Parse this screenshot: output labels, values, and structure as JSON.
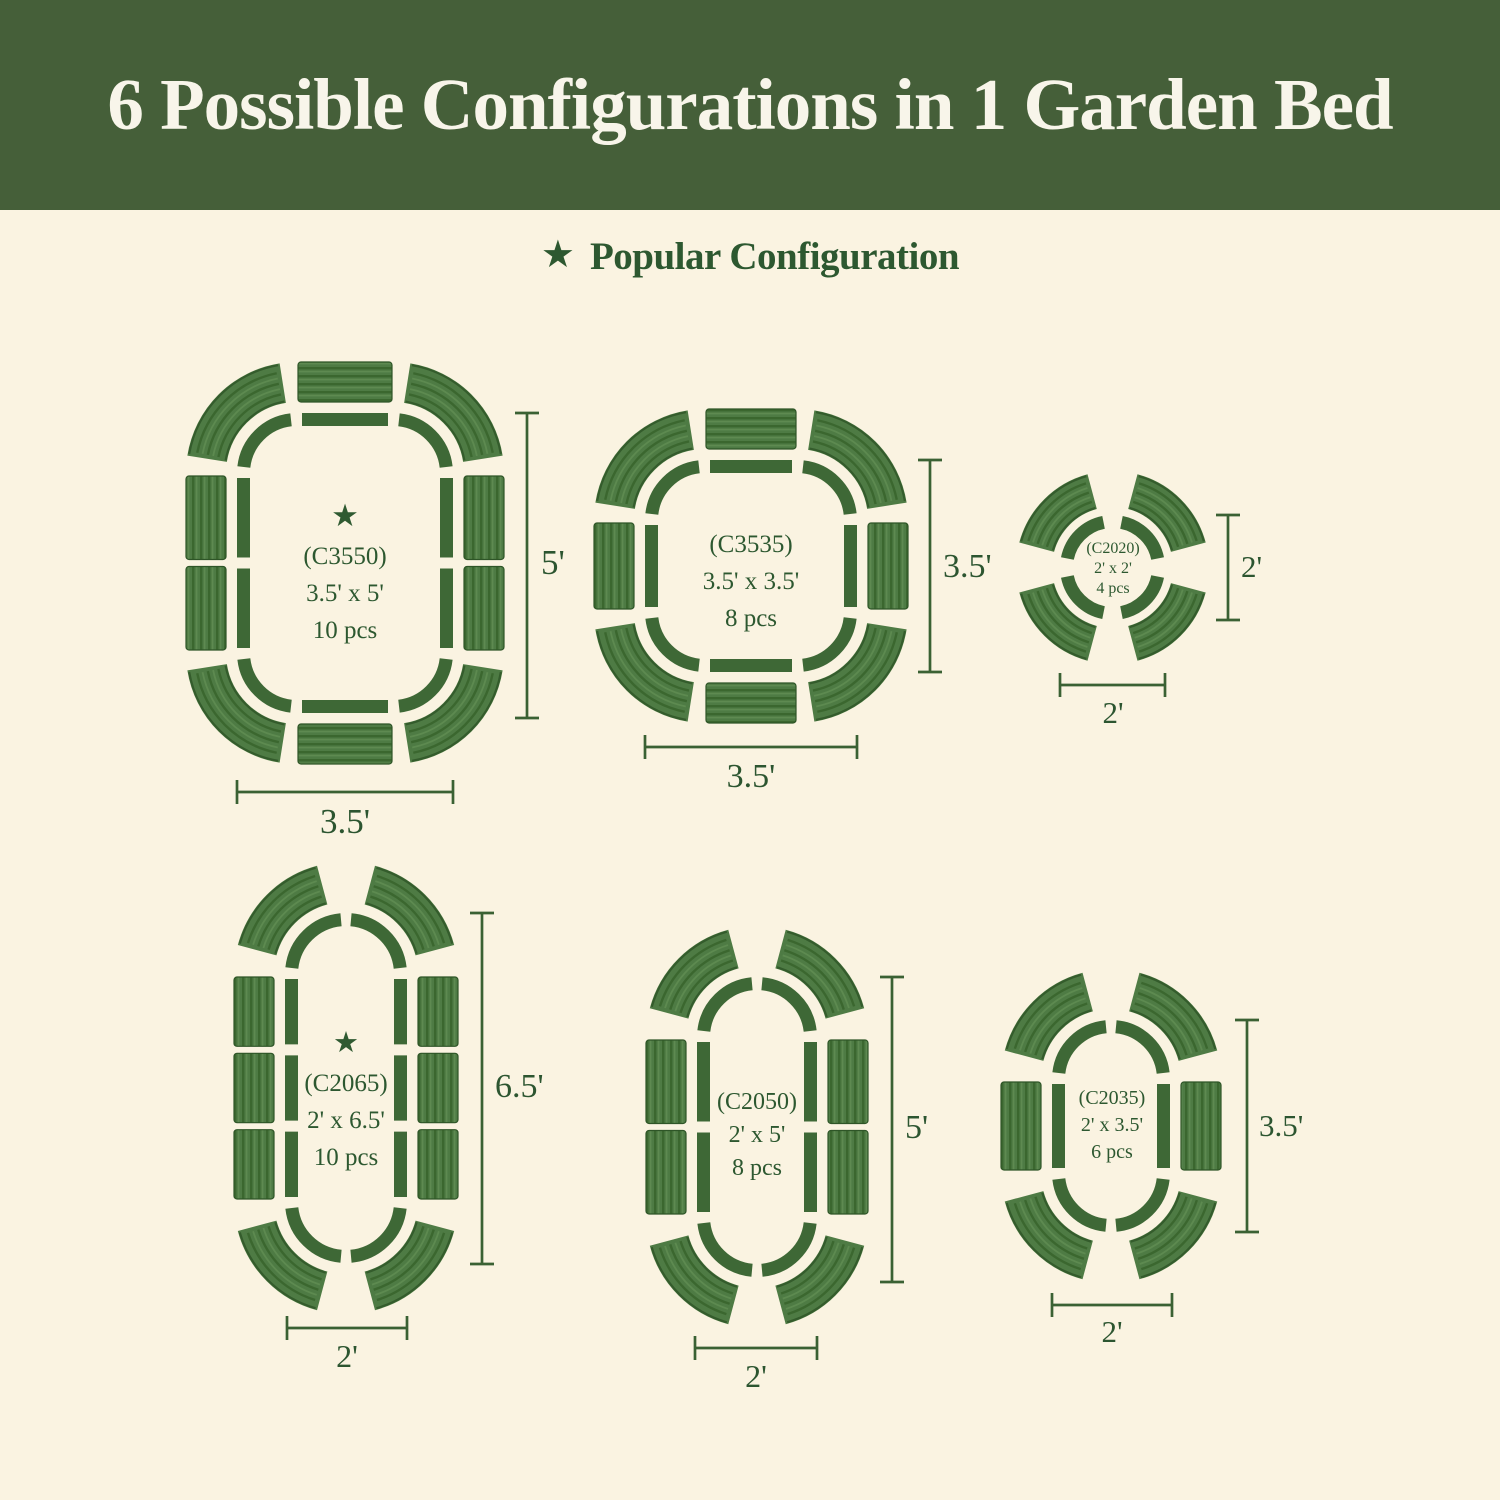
{
  "header": {
    "title": "6 Possible Configurations in 1 Garden Bed"
  },
  "legend": {
    "star": "★",
    "label": "Popular Configuration"
  },
  "colors": {
    "header_bg": "#455f39",
    "background": "#faf3e1",
    "text_green": "#2d5830",
    "outline_green": "#3e6836",
    "dim_green": "#3a6133",
    "panel_base": "#4e7b44",
    "panel_rib_dark": "#3b672f",
    "panel_rib_light": "#5f8c52",
    "panel_edge": "#2e5527"
  },
  "configurations": [
    {
      "id": "C3550",
      "code_label": "(C3550)",
      "size_label": "3.5' x 5'",
      "pieces_label": "10 pcs",
      "pieces": 10,
      "popular": true,
      "shape": "rounded-rectangle",
      "height_label": "5'",
      "width_label": "3.5'"
    },
    {
      "id": "C3535",
      "code_label": "(C3535)",
      "size_label": "3.5' x 3.5'",
      "pieces_label": "8 pcs",
      "pieces": 8,
      "popular": false,
      "shape": "rounded-square",
      "height_label": "3.5'",
      "width_label": "3.5'"
    },
    {
      "id": "C2020",
      "code_label": "(C2020)",
      "size_label": "2' x 2'",
      "pieces_label": "4 pcs",
      "pieces": 4,
      "popular": false,
      "shape": "circle",
      "height_label": "2'",
      "width_label": "2'"
    },
    {
      "id": "C2065",
      "code_label": "(C2065)",
      "size_label": "2' x 6.5'",
      "pieces_label": "10 pcs",
      "pieces": 10,
      "popular": true,
      "shape": "pill",
      "height_label": "6.5'",
      "width_label": "2'"
    },
    {
      "id": "C2050",
      "code_label": "(C2050)",
      "size_label": "2' x 5'",
      "pieces_label": "8 pcs",
      "pieces": 8,
      "popular": false,
      "shape": "pill",
      "height_label": "5'",
      "width_label": "2'"
    },
    {
      "id": "C2035",
      "code_label": "(C2035)",
      "size_label": "2' x 3.5'",
      "pieces_label": "6 pcs",
      "pieces": 6,
      "popular": false,
      "shape": "pill",
      "height_label": "3.5'",
      "width_label": "2'"
    }
  ]
}
